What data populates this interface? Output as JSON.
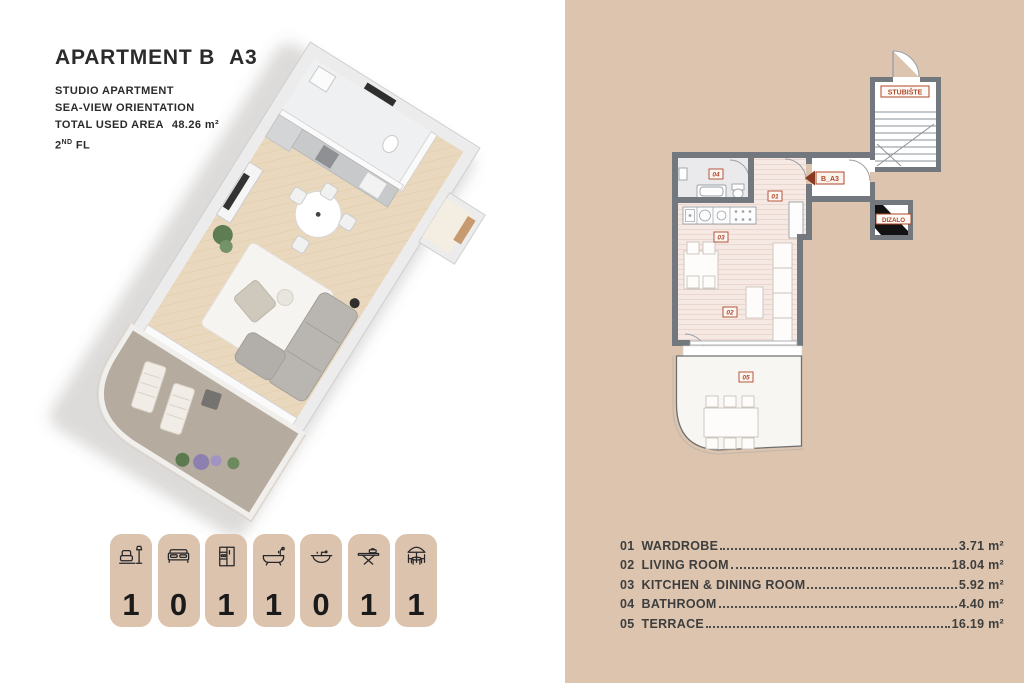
{
  "header": {
    "title_main": "APARTMENT B",
    "title_code": "A3",
    "subtitle_line1": "STUDIO APARTMENT",
    "subtitle_line2": "SEA-VIEW ORIENTATION",
    "area_label": "TOTAL USED AREA",
    "area_value": "48.26 m²",
    "floor_number": "2",
    "floor_sup": "ND",
    "floor_label": "FL"
  },
  "badges": [
    {
      "icon": "sofa-lamp-icon",
      "count": "1"
    },
    {
      "icon": "bed-icon",
      "count": "0"
    },
    {
      "icon": "kitchen-icon",
      "count": "1"
    },
    {
      "icon": "bathtub-icon",
      "count": "1"
    },
    {
      "icon": "washbasin-icon",
      "count": "0"
    },
    {
      "icon": "ironing-board-icon",
      "count": "1"
    },
    {
      "icon": "terrace-icon",
      "count": "1"
    }
  ],
  "plan": {
    "labels": {
      "staircase": "STUBIŠTE",
      "elevator": "DIZALO",
      "unit": "B_A3",
      "room01": "01",
      "room02": "02",
      "room03": "03",
      "room04": "04",
      "room05": "05"
    }
  },
  "room_list": [
    {
      "num": "01",
      "name": "WARDROBE",
      "area": "3.71 m²"
    },
    {
      "num": "02",
      "name": "LIVING ROOM",
      "area": "18.04 m²"
    },
    {
      "num": "03",
      "name": "KITCHEN & DINING ROOM",
      "area": "5.92 m²"
    },
    {
      "num": "04",
      "name": "BATHROOM",
      "area": "4.40 m²"
    },
    {
      "num": "05",
      "name": "TERRACE",
      "area": "16.19 m²"
    }
  ],
  "colors": {
    "panel_tan": "#dcc4ae",
    "badge_tan": "#dbc3ad",
    "wall_gray": "#73777e",
    "label_red": "#b0472b",
    "floor_pink": "#f6e9e4"
  }
}
